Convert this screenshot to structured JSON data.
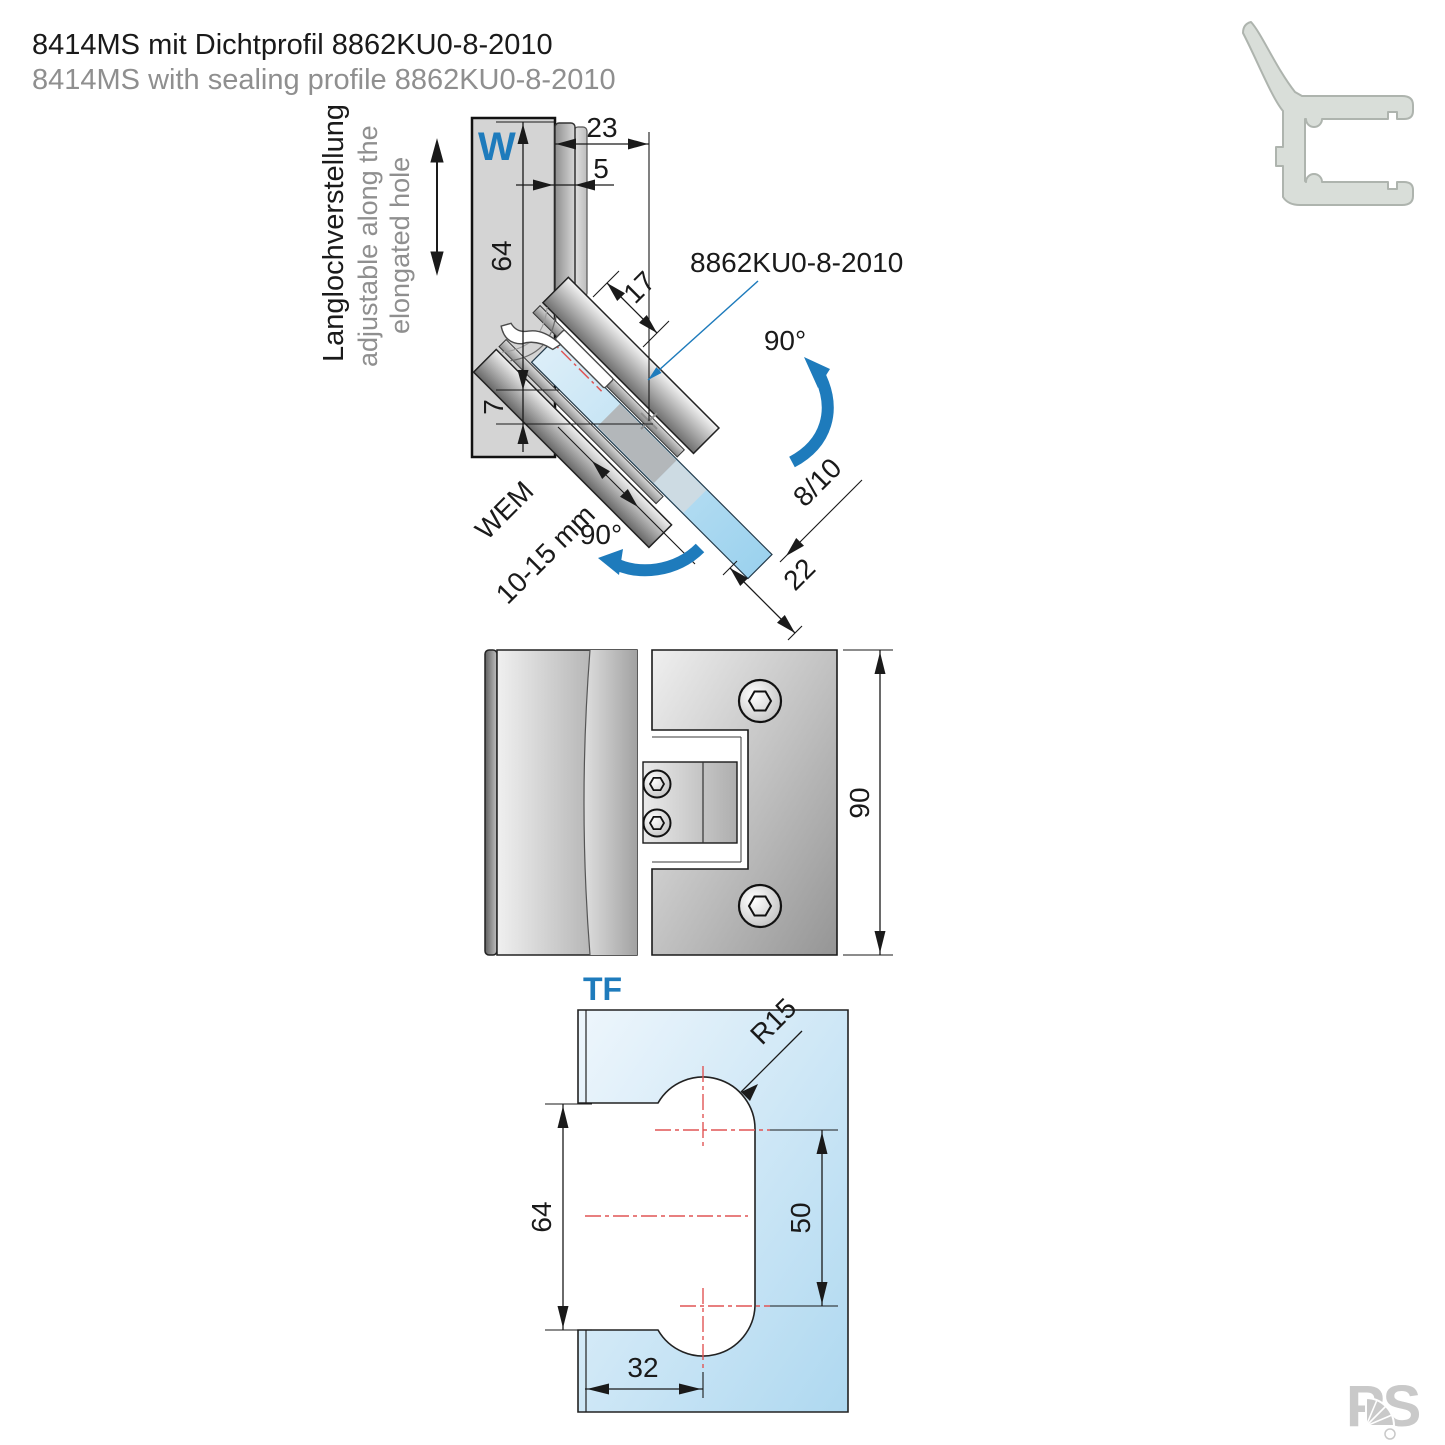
{
  "title": {
    "de": "8414MS mit Dichtprofil 8862KU0-8-2010",
    "en": "8414MS with sealing profile 8862KU0-8-2010"
  },
  "side_view": {
    "wall_label": "W",
    "note_de": "Langlochverstellung",
    "note_en_line1": "adjustable along the",
    "note_en_line2": "elongated hole",
    "seal_label": "8862KU0-8-2010",
    "swing_angle_top": "90°",
    "swing_angle_bottom": "90°",
    "wem_label": "WEM",
    "wem_value": "10-15 mm",
    "dims": {
      "offset": "23",
      "plate": "5",
      "height": "64",
      "drop": "7",
      "axis": "17",
      "glass_thickness": "8/10",
      "overhang": "22"
    }
  },
  "front_view": {
    "dims": {
      "height": "90"
    }
  },
  "glass_view": {
    "label": "TF",
    "dims": {
      "radius": "R15",
      "cutout_height": "64",
      "centers": "50",
      "depth": "32"
    }
  },
  "logo": {
    "text": "PS"
  },
  "colors": {
    "accent_blue": "#1e7bbc",
    "centerline_red": "#e05555",
    "glass_blue": "#aed8f0",
    "metal_gray": "#9a9a9a",
    "title_gray": "#8f8f8f",
    "profile_icon_gray": "#d9ded9"
  }
}
